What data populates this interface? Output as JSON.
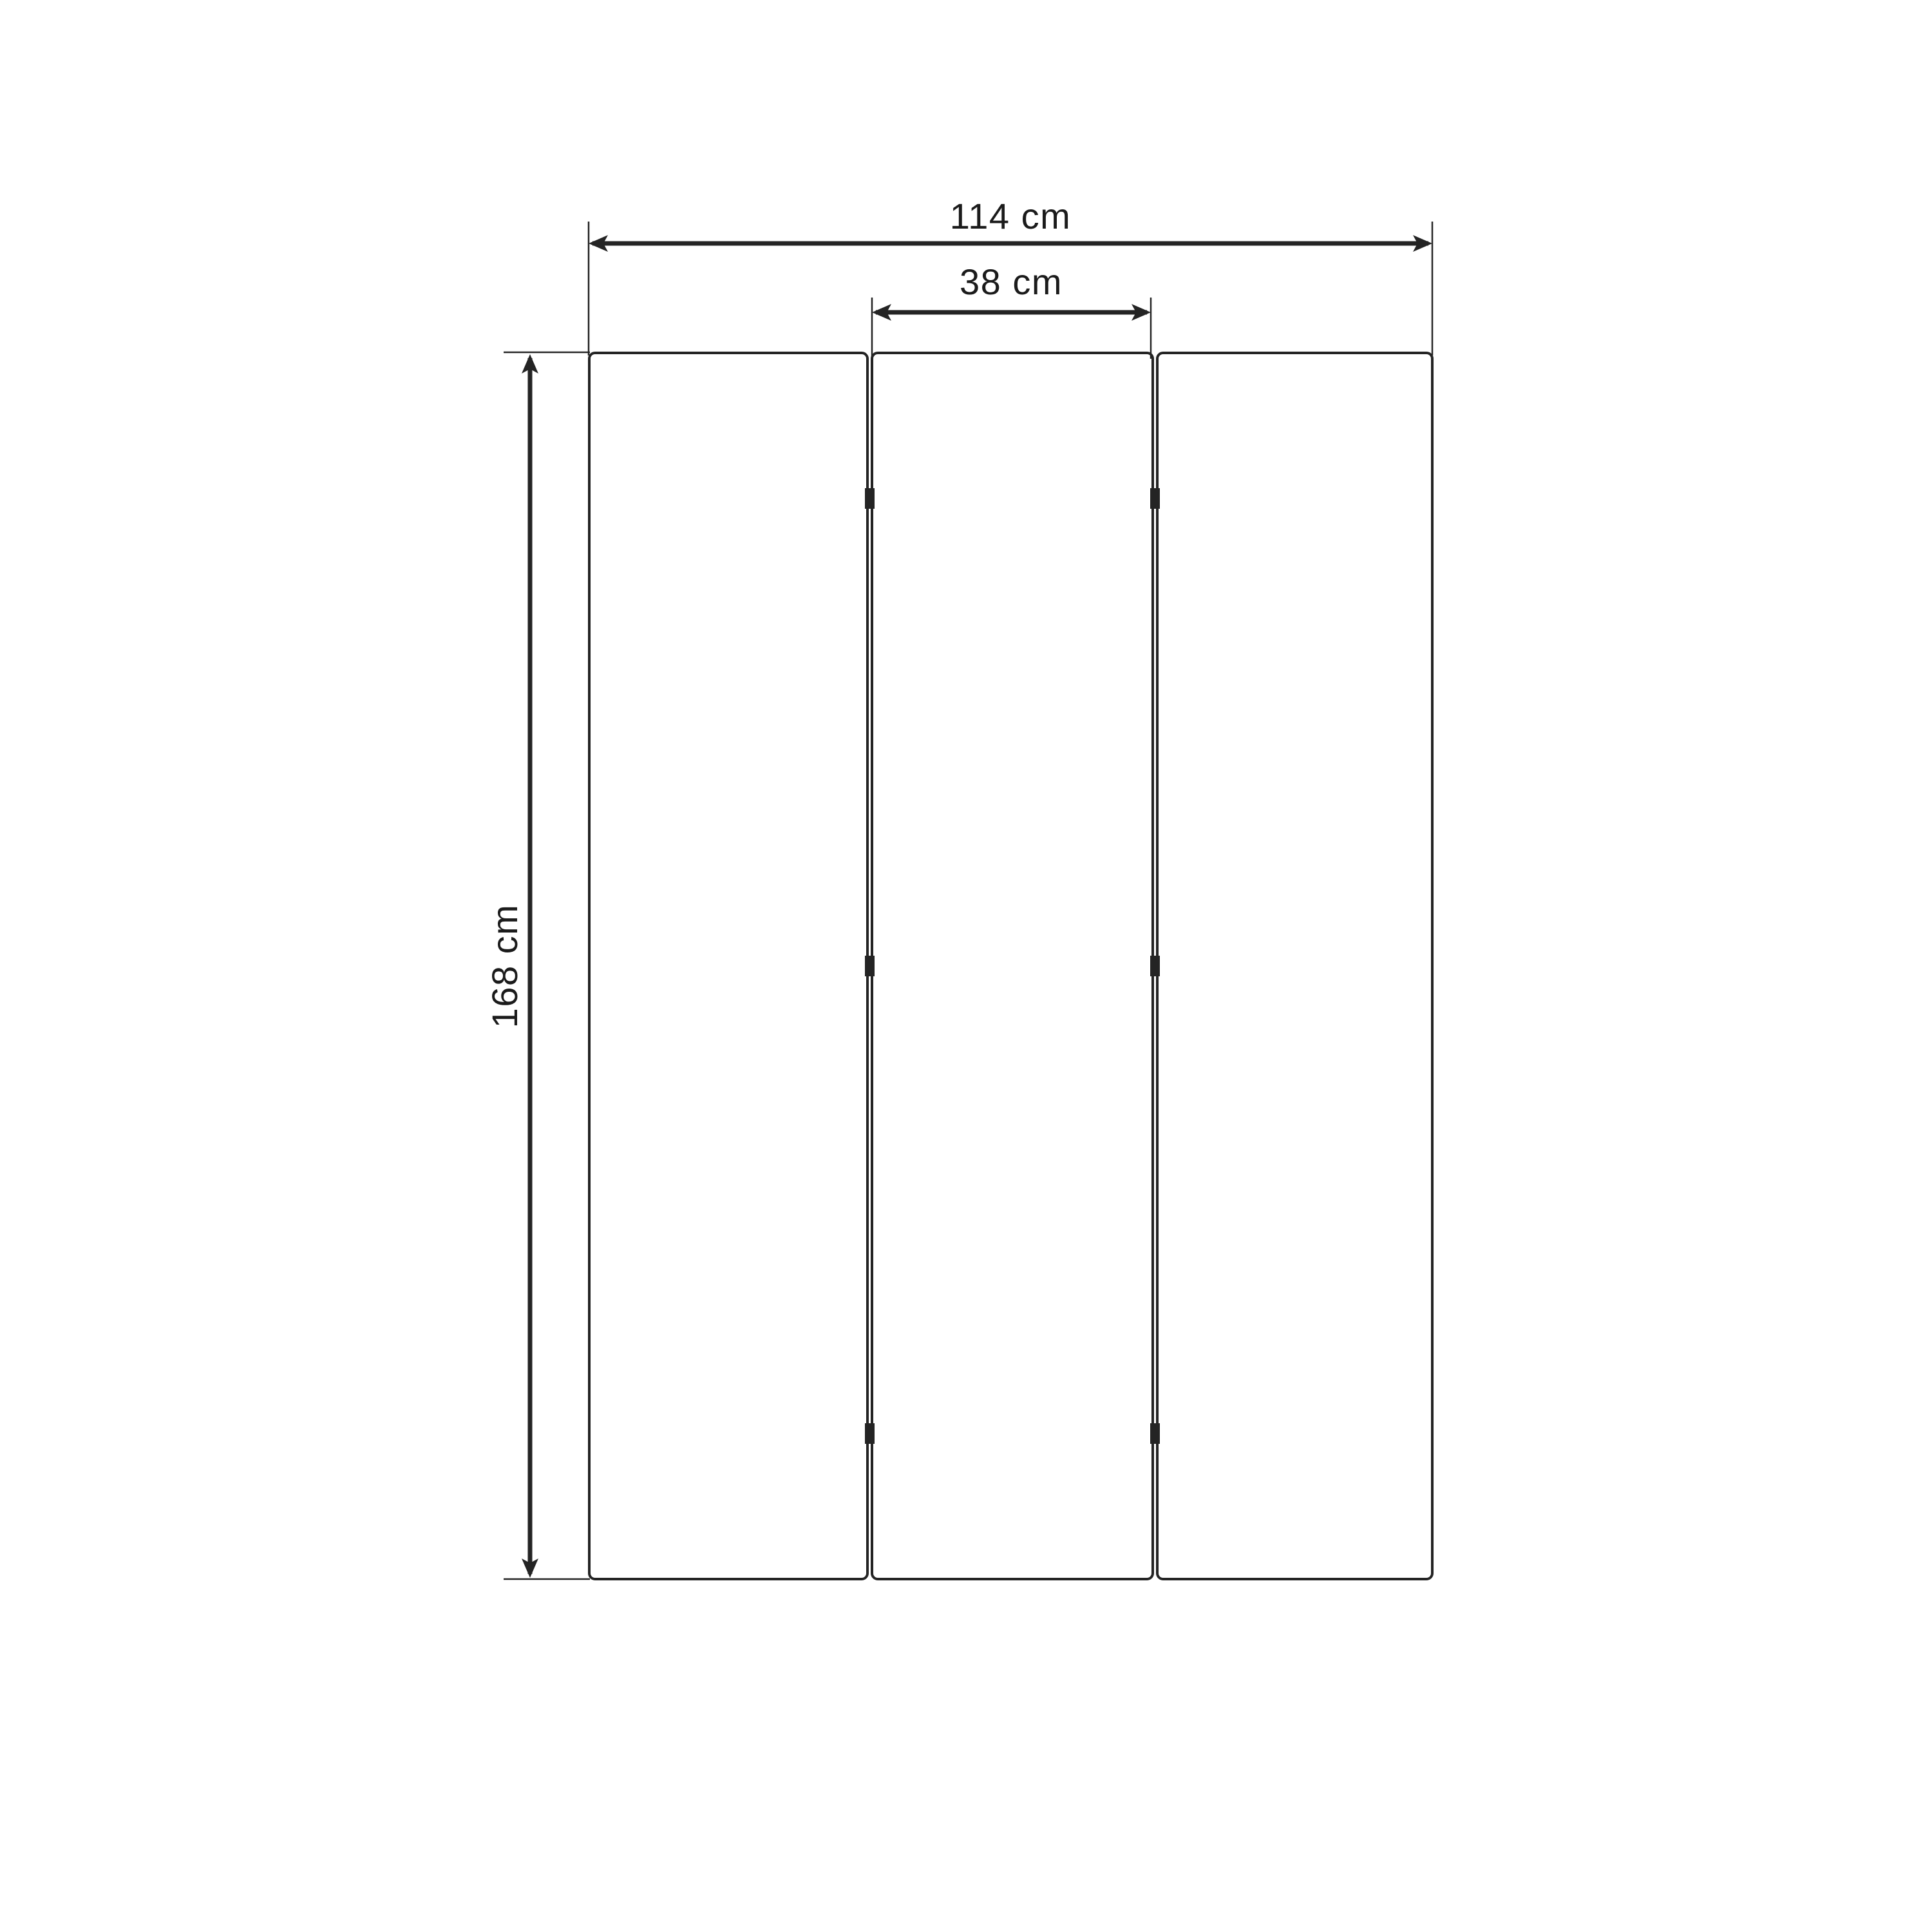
{
  "diagram": {
    "unit": "cm",
    "dimensions": {
      "total_width": {
        "value": 114,
        "unit": "cm",
        "label": "114 cm"
      },
      "panel_width": {
        "value": 38,
        "unit": "cm",
        "label": "38 cm"
      },
      "height": {
        "value": 168,
        "unit": "cm",
        "label": "168 cm"
      }
    },
    "panels": {
      "count": 3,
      "gaps": 2,
      "hinges_per_gap": 3
    },
    "colors": {
      "background": "#ffffff",
      "stroke": "#242424",
      "text": "#1b1b1b"
    }
  }
}
